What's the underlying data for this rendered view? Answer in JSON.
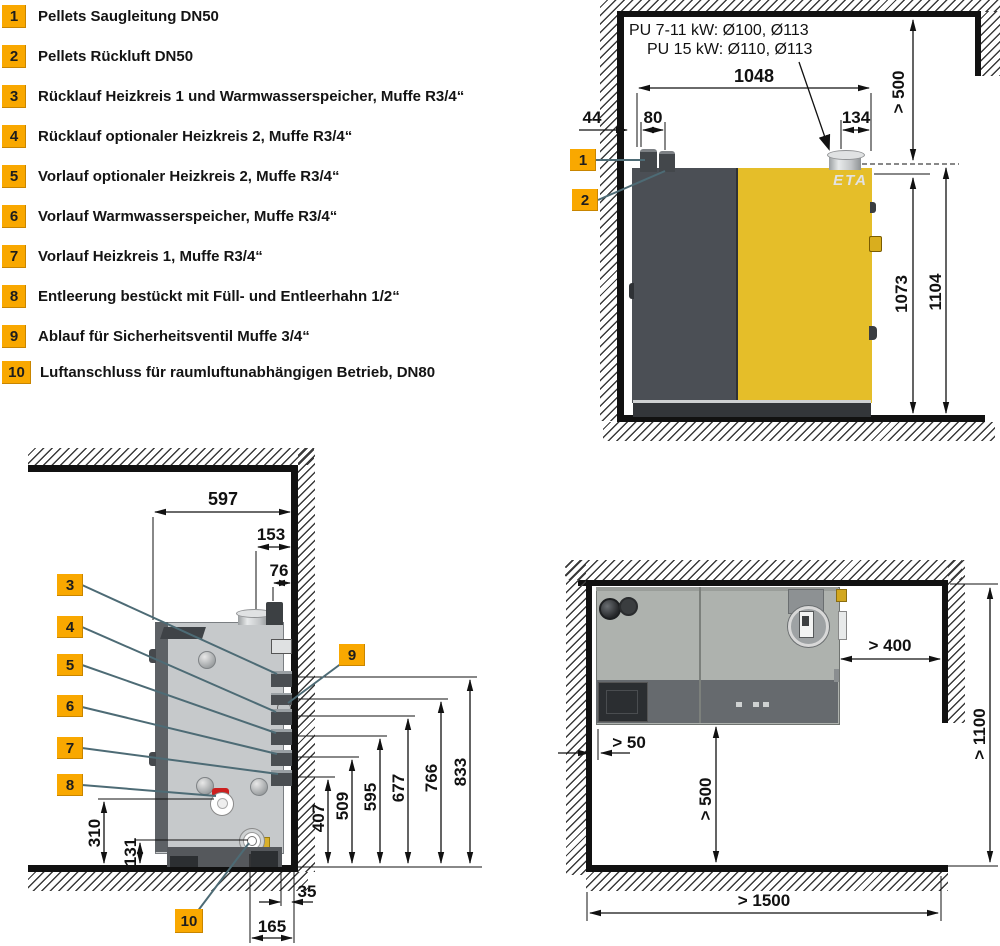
{
  "colors": {
    "accent_orange": "#F9A800",
    "boiler_yellow": "#E5BE29",
    "boiler_dark_gray": "#4B4F55",
    "side_body_gray": "#C6C9CB",
    "top_body_gray": "#AEB2AE",
    "leader_line": "#4D6B75"
  },
  "legend": {
    "items": [
      {
        "num": "1",
        "text": "Pellets Saugleitung DN50"
      },
      {
        "num": "2",
        "text": "Pellets Rückluft DN50"
      },
      {
        "num": "3",
        "text": "Rücklauf Heizkreis 1 und Warmwasserspeicher, Muffe R3/4“"
      },
      {
        "num": "4",
        "text": "Rücklauf optionaler Heizkreis 2, Muffe R3/4“"
      },
      {
        "num": "5",
        "text": "Vorlauf optionaler Heizkreis 2, Muffe R3/4“"
      },
      {
        "num": "6",
        "text": "Vorlauf Warmwasserspeicher, Muffe R3/4“"
      },
      {
        "num": "7",
        "text": "Vorlauf Heizkreis 1, Muffe R3/4“"
      },
      {
        "num": "8",
        "text": "Entleerung bestückt mit Füll- und Entleerhahn 1/2“"
      },
      {
        "num": "9",
        "text": "Ablauf für Sicherheitsventil Muffe 3/4“"
      },
      {
        "num": "10",
        "text": "Luftanschluss für raumluftunabhängigen Betrieb, DN80"
      }
    ]
  },
  "front_view": {
    "note_line1": "PU 7-11 kW: Ø100, Ø113",
    "note_line2": "PU 15 kW: Ø110, Ø113",
    "logo": "ETA",
    "callouts": {
      "c1": "1",
      "c2": "2"
    },
    "dims": {
      "width": "1048",
      "wall_gap": "44",
      "pipe_spacing": "80",
      "chimney_offset": "134",
      "ceiling_clearance": "> 500",
      "height_body": "1073",
      "height_total": "1104"
    }
  },
  "side_view": {
    "callouts": {
      "c3": "3",
      "c4": "4",
      "c5": "5",
      "c6": "6",
      "c7": "7",
      "c8": "8",
      "c9": "9",
      "c10": "10"
    },
    "dims": {
      "depth": "597",
      "chimney_from_wall": "153",
      "pipe_from_wall": "76",
      "h_c3": "833",
      "h_c9": "766",
      "h_c4": "677",
      "h_c5": "595",
      "h_c6": "509",
      "h_c7": "407",
      "valve_height": "310",
      "air_height": "131",
      "rear_gap": "35",
      "air_from_wall": "165"
    }
  },
  "top_view": {
    "dims": {
      "side_clearance": "> 400",
      "rear_gap": "> 50",
      "front_clearance": "> 500",
      "room_depth": "> 1100",
      "room_width": "> 1500"
    }
  }
}
